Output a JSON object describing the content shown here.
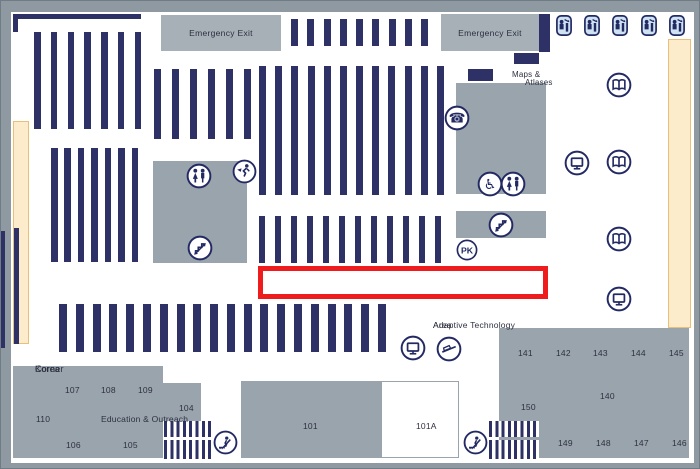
{
  "colors": {
    "frame": "#8e99a2",
    "floor": "#ffffff",
    "navy": "#2e3166",
    "icon": "#232a63",
    "room": "#99a4ac",
    "exit_box": "#a7b0b7",
    "window": "#fdeccb",
    "window_border": "#e9bf79",
    "highlight": "#ee1c1c",
    "text": "#2e3040",
    "carrel_bg": "#cfe2f2"
  },
  "map": {
    "floor": {
      "x": 10,
      "y": 11,
      "w": 683,
      "h": 451
    },
    "walls": [
      {
        "x": 12,
        "y": 13,
        "w": 128,
        "h": 5
      },
      {
        "x": 12,
        "y": 13,
        "w": 5,
        "h": 18
      },
      {
        "x": 538,
        "y": 13,
        "w": 11,
        "h": 38
      },
      {
        "x": 513,
        "y": 52,
        "w": 25,
        "h": 11
      },
      {
        "x": 467,
        "y": 68,
        "w": 25,
        "h": 12
      },
      {
        "x": 0,
        "y": 230,
        "w": 4,
        "h": 117
      },
      {
        "x": 13,
        "y": 227,
        "w": 5,
        "h": 116
      }
    ],
    "windows": [
      {
        "x": 12,
        "y": 120,
        "w": 16,
        "h": 223
      },
      {
        "x": 667,
        "y": 38,
        "w": 23,
        "h": 289
      }
    ],
    "exit_boxes": [
      {
        "x": 160,
        "y": 14,
        "w": 120,
        "h": 36,
        "label": "Emergency Exit"
      },
      {
        "x": 440,
        "y": 13,
        "w": 98,
        "h": 37,
        "label": "Emergency Exit"
      }
    ],
    "gray_areas": [
      {
        "name": "restroom-stairs-block",
        "x": 152,
        "y": 160,
        "w": 94,
        "h": 102
      },
      {
        "name": "maps-atlases-block",
        "x": 455,
        "y": 82,
        "w": 90,
        "h": 111
      },
      {
        "name": "stairs-block",
        "x": 455,
        "y": 210,
        "w": 90,
        "h": 27
      }
    ],
    "rooms": [
      {
        "name": "room-education-outreach",
        "x": 12,
        "y": 365,
        "w": 150,
        "h": 92,
        "fill": "gray"
      },
      {
        "name": "room-104",
        "x": 162,
        "y": 382,
        "w": 38,
        "h": 38,
        "fill": "gray"
      },
      {
        "name": "room-101",
        "x": 240,
        "y": 380,
        "w": 140,
        "h": 77,
        "fill": "gray"
      },
      {
        "name": "room-101a",
        "x": 380,
        "y": 380,
        "w": 78,
        "h": 77,
        "fill": "white"
      },
      {
        "name": "room-140s",
        "x": 498,
        "y": 327,
        "w": 190,
        "h": 130,
        "fill": "gray"
      }
    ],
    "shelf_groups": [
      {
        "name": "book-stacks-a",
        "x": 33,
        "y": 31,
        "w": 107,
        "h": 97,
        "bars": 7,
        "bw": 6.5
      },
      {
        "name": "book-stacks-b",
        "x": 50,
        "y": 147,
        "w": 87,
        "h": 114,
        "bars": 7,
        "bw": 6.5
      },
      {
        "name": "book-stacks-c",
        "x": 153,
        "y": 68,
        "w": 97,
        "h": 70,
        "bars": 6,
        "bw": 7
      },
      {
        "name": "book-stacks-d",
        "x": 258,
        "y": 65,
        "w": 185,
        "h": 129,
        "bars": 12,
        "bw": 7
      },
      {
        "name": "book-stacks-e",
        "x": 290,
        "y": 18,
        "w": 137,
        "h": 27,
        "bars": 9,
        "bw": 7
      },
      {
        "name": "book-stacks-f",
        "x": 258,
        "y": 215,
        "w": 182,
        "h": 47,
        "bars": 12,
        "bw": 6
      },
      {
        "name": "book-stacks-g",
        "x": 58,
        "y": 303,
        "w": 327,
        "h": 48,
        "bars": 20,
        "bw": 8
      }
    ],
    "stair_hatches": [
      {
        "x": 163,
        "y": 420,
        "w": 47
      },
      {
        "x": 488,
        "y": 420,
        "w": 50
      }
    ],
    "highlight": {
      "x": 257,
      "y": 265,
      "w": 290,
      "h": 33,
      "border": 5
    },
    "texts": [
      {
        "name": "label-korea-corner",
        "lines": [
          "Korea",
          "Corner"
        ],
        "cx": 34,
        "cy": 363,
        "fs": 9
      },
      {
        "name": "label-maps",
        "lines": [
          "Maps &"
        ],
        "cx": 511,
        "cy": 69,
        "fs": 8
      },
      {
        "name": "label-atlases",
        "lines": [
          "Atlases"
        ],
        "cx": 524,
        "cy": 77,
        "fs": 8
      },
      {
        "name": "label-adaptive-technology-area",
        "lines": [
          "Adaptive Technology",
          "Area"
        ],
        "cx": 432,
        "cy": 319,
        "fs": 8.5
      },
      {
        "name": "label-education-outreach",
        "lines": [
          "Education & Outreach"
        ],
        "cx": 100,
        "cy": 413,
        "fs": 8.5
      },
      {
        "name": "room-label-107",
        "lines": [
          "107"
        ],
        "cx": 64,
        "cy": 384
      },
      {
        "name": "room-label-108",
        "lines": [
          "108"
        ],
        "cx": 100,
        "cy": 384
      },
      {
        "name": "room-label-109",
        "lines": [
          "109"
        ],
        "cx": 137,
        "cy": 384
      },
      {
        "name": "room-label-110",
        "lines": [
          "110"
        ],
        "cx": 35,
        "cy": 413
      },
      {
        "name": "room-label-106",
        "lines": [
          "106"
        ],
        "cx": 65,
        "cy": 439
      },
      {
        "name": "room-label-105",
        "lines": [
          "105"
        ],
        "cx": 122,
        "cy": 439
      },
      {
        "name": "room-label-104",
        "lines": [
          "104"
        ],
        "cx": 178,
        "cy": 402
      },
      {
        "name": "room-label-101",
        "lines": [
          "101"
        ],
        "cx": 302,
        "cy": 420
      },
      {
        "name": "room-label-101a",
        "lines": [
          "101A"
        ],
        "cx": 415,
        "cy": 420
      },
      {
        "name": "room-label-141",
        "lines": [
          "141"
        ],
        "cx": 517,
        "cy": 347
      },
      {
        "name": "room-label-142",
        "lines": [
          "142"
        ],
        "cx": 555,
        "cy": 347
      },
      {
        "name": "room-label-143",
        "lines": [
          "143"
        ],
        "cx": 592,
        "cy": 347
      },
      {
        "name": "room-label-144",
        "lines": [
          "144"
        ],
        "cx": 630,
        "cy": 347
      },
      {
        "name": "room-label-145",
        "lines": [
          "145"
        ],
        "cx": 668,
        "cy": 347
      },
      {
        "name": "room-label-140",
        "lines": [
          "140"
        ],
        "cx": 599,
        "cy": 390
      },
      {
        "name": "room-label-150",
        "lines": [
          "150"
        ],
        "cx": 520,
        "cy": 401
      },
      {
        "name": "room-label-149",
        "lines": [
          "149"
        ],
        "cx": 557,
        "cy": 437
      },
      {
        "name": "room-label-148",
        "lines": [
          "148"
        ],
        "cx": 595,
        "cy": 437
      },
      {
        "name": "room-label-147",
        "lines": [
          "147"
        ],
        "cx": 633,
        "cy": 437
      },
      {
        "name": "room-label-146",
        "lines": [
          "146"
        ],
        "cx": 671,
        "cy": 437
      }
    ],
    "icons": [
      {
        "type": "restroom",
        "name": "restroom-icon",
        "cx": 198,
        "cy": 175,
        "d": 26
      },
      {
        "type": "exit-run",
        "name": "emergency-exit-run-icon",
        "cx": 243,
        "cy": 170,
        "d": 25
      },
      {
        "type": "stairs",
        "name": "stairs-icon",
        "cx": 199,
        "cy": 247,
        "d": 26
      },
      {
        "type": "phone",
        "name": "telephone-icon",
        "cx": 456,
        "cy": 117,
        "d": 26
      },
      {
        "type": "wheelchair",
        "name": "accessible-icon",
        "cx": 489,
        "cy": 183,
        "d": 26
      },
      {
        "type": "restroom",
        "name": "restroom-icon",
        "cx": 512,
        "cy": 183,
        "d": 26
      },
      {
        "type": "stairs",
        "name": "stairs-icon",
        "cx": 500,
        "cy": 224,
        "d": 26
      },
      {
        "type": "pk",
        "name": "pk-icon",
        "label": "PK",
        "cx": 466,
        "cy": 249,
        "d": 22
      },
      {
        "type": "monitor",
        "name": "computer-icon",
        "cx": 576,
        "cy": 162,
        "d": 26
      },
      {
        "type": "book",
        "name": "open-book-icon",
        "cx": 618,
        "cy": 84,
        "d": 26
      },
      {
        "type": "book",
        "name": "open-book-icon",
        "cx": 618,
        "cy": 161,
        "d": 26
      },
      {
        "type": "book",
        "name": "open-book-icon",
        "cx": 618,
        "cy": 238,
        "d": 26
      },
      {
        "type": "monitor",
        "name": "computer-icon",
        "cx": 618,
        "cy": 298,
        "d": 26
      },
      {
        "type": "monitor",
        "name": "computer-icon",
        "cx": 412,
        "cy": 347,
        "d": 26
      },
      {
        "type": "scanner",
        "name": "scanner-icon",
        "cx": 448,
        "cy": 348,
        "d": 26
      },
      {
        "type": "escalator",
        "name": "escalator-icon",
        "cx": 224,
        "cy": 441,
        "d": 25
      },
      {
        "type": "escalator",
        "name": "escalator-icon",
        "cx": 474,
        "cy": 441,
        "d": 25
      }
    ],
    "carrels": {
      "y": 14,
      "w": 16,
      "h": 21,
      "xs": [
        555,
        583,
        611,
        640,
        668
      ]
    }
  }
}
